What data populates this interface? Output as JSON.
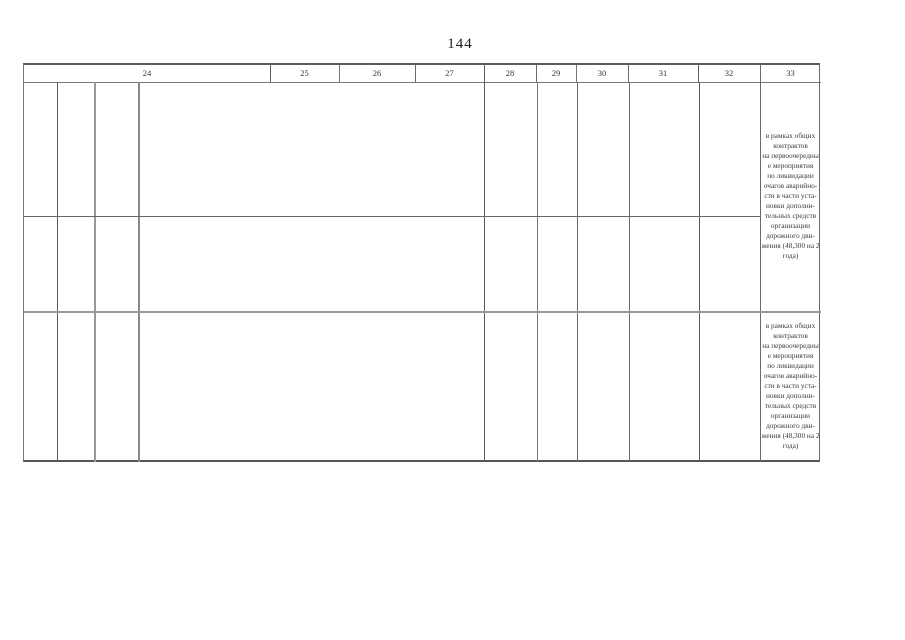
{
  "page": {
    "number": "144"
  },
  "table": {
    "header": {
      "columns": [
        "24",
        "25",
        "26",
        "27",
        "28",
        "29",
        "30",
        "31",
        "32",
        "33"
      ]
    },
    "column33": {
      "block1": "в рамках общих\nконтрактов\nна первоочередны\nе мероприятия\nпо ликвидации\nочагов аварийно-\nсти в части уста-\nновки дополни-\nтельных средств\nорганизации\nдорожного дви-\nжения (48,300 на 2\nгода)",
      "block2": "в рамках общих\nконтрактов\nна первоочередны\nе мероприятия\nпо ликвидации\nочагов аварийно-\nсти в части уста-\nновки дополни-\nтельных средств\nорганизации\nдорожного дви-\nжения (48,300 на 2\nгода)"
    }
  }
}
